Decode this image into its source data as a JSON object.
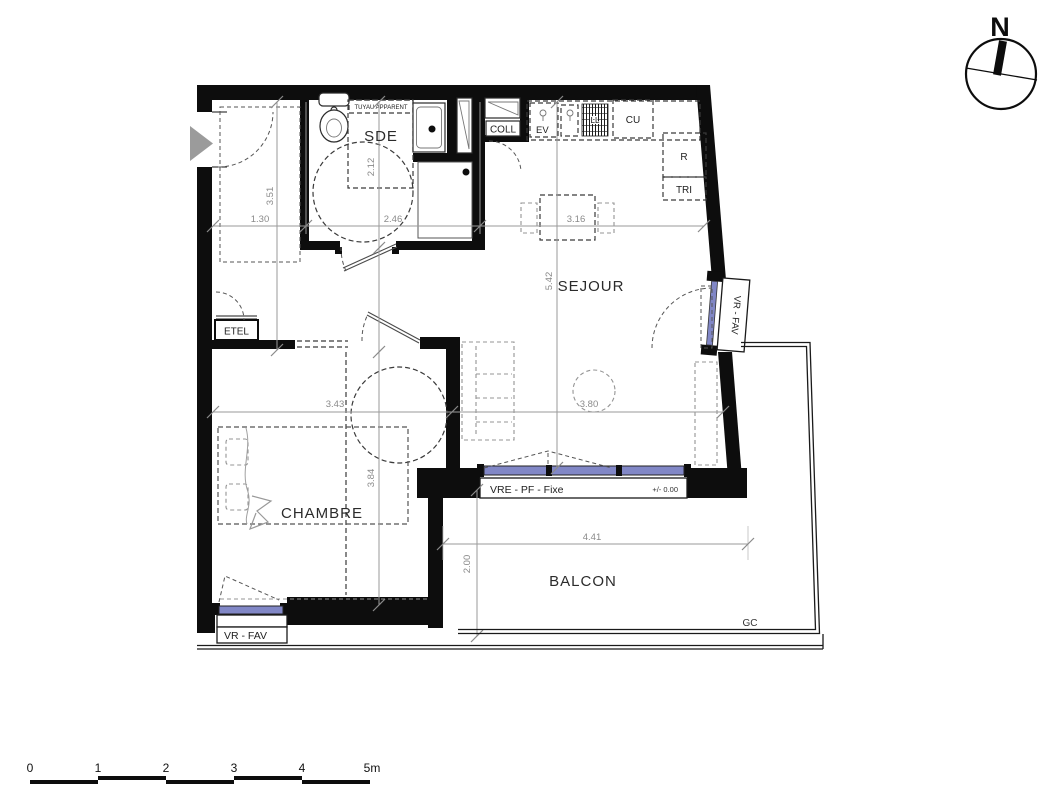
{
  "plan": {
    "rooms": {
      "sde": "SDE",
      "sejour": "SEJOUR",
      "chambre": "CHAMBRE",
      "balcon": "BALCON"
    },
    "fixtures": {
      "tuyau_apparent": "TUYAU APPARENT",
      "ev": "EV",
      "ll": "LL",
      "cu": "CU",
      "r": "R",
      "tri": "TRI",
      "coll": "COLL",
      "etel": "ETEL",
      "gc": "GC"
    },
    "windows": {
      "vr_fav_right": "VR - FAV",
      "vr_fav_bottom": "VR - FAV",
      "vre_pf_fixe": "VRE - PF - Fixe",
      "level": "+/- 0.00"
    },
    "dimensions": {
      "entree_largeur": "1.30",
      "sde_largeur": "2.46",
      "cuisine_largeur": "3.16",
      "entree_hauteur": "3.51",
      "sde_profondeur": "2.12",
      "sejour_hauteur": "5.42",
      "chambre_largeur": "3.43",
      "sejour_largeur": "3.80",
      "chambre_hauteur": "3.84",
      "balcon_profondeur": "2.00",
      "balcon_largeur": "4.41"
    }
  },
  "north_arrow": {
    "label": "N"
  },
  "scale_bar": {
    "labels": [
      "0",
      "1",
      "2",
      "3",
      "4",
      "5m"
    ]
  },
  "colors": {
    "wall": "#0d0d0d",
    "glazing": "#8187c6",
    "dimension": "#8a8a8a",
    "entry_arrow": "#9b9b9b"
  }
}
